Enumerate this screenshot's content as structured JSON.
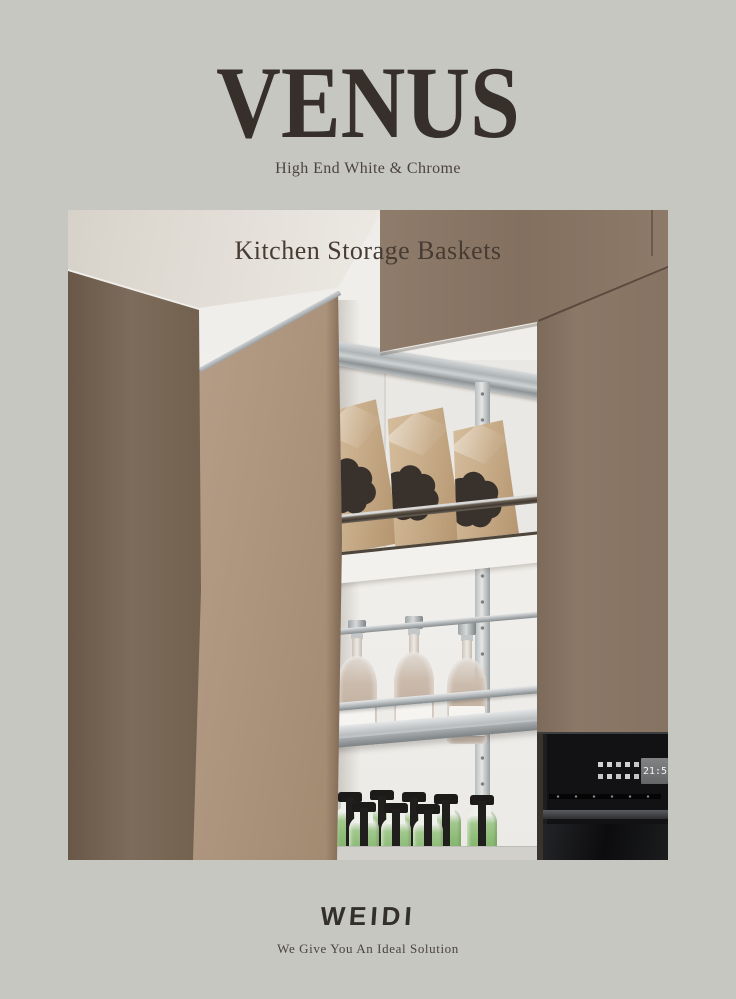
{
  "header": {
    "title": "VENUS",
    "subtitle": "High End White & Chrome"
  },
  "hero": {
    "caption": "Kitchen Storage Baskets",
    "oven_time": "21:5"
  },
  "footer": {
    "brand": "WEIDI",
    "tagline": "We Give You An Ideal Solution"
  },
  "colors": {
    "background": "#c6c7c0",
    "title_ink": "#362f2a",
    "text_ink": "#4b443c",
    "caption_ink": "#463c33",
    "brand_ink": "#33302b",
    "wood_dark": "#75634f",
    "wood_light": "#b29a83",
    "wood_right": "#897666",
    "chrome": "#b9bdbf",
    "kraft": "#c8ad8a",
    "bottle_green": "#8cbb76",
    "oven_black": "#141416"
  }
}
